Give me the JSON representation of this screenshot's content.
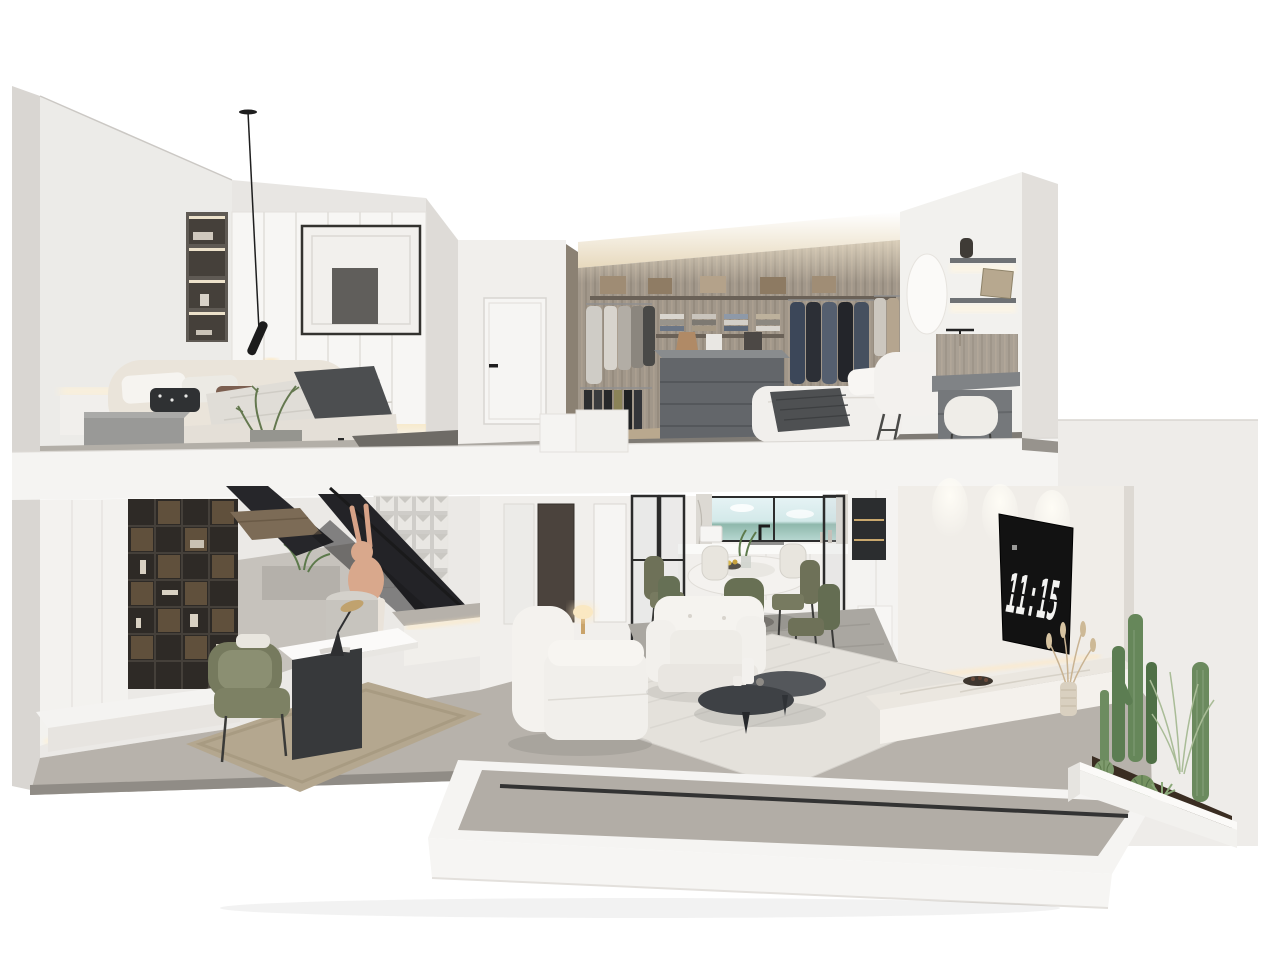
{
  "meta": {
    "description": "Photorealistic 3D dollhouse cutaway rendering of a two-storey duplex apartment, white/grey minimalist interior, viewed in section",
    "view": "isometric section cutaway",
    "floors": 2
  },
  "tv": {
    "clock_time": "11:15",
    "screen_color": "#121212",
    "digit_color": "#f3f3f1"
  },
  "palette": {
    "background": "#ffffff",
    "exterior_cut_wall": "#d9d6d2",
    "interior_wall": "#ecebe8",
    "wall_shadow_side": "#dedbd7",
    "slab_white": "#f5f4f2",
    "floor_gray": "#b7b2ab",
    "closet_carpet": "#7f7b75",
    "closet_wood": "#a1978a",
    "bookshelf_dark": "#2e2a26",
    "steel_black": "#232327",
    "olive_chair": "#6e7158",
    "bed_beige": "#eae4da",
    "duvet_gray": "#e0ddd7",
    "throw_dark": "#4c4e50",
    "rug_beige": "#b4a78f",
    "rug_cream": "#e4e1db",
    "marble": "#ebe7e0",
    "led_warm": "#ffe9c0",
    "rabbit_skin": "#d9a88c",
    "cactus_green": "#66875a",
    "soil_brown": "#3a2d22",
    "suit_navy": "#3c4759",
    "window_view_sky": "#e6f3f5",
    "window_view_hills": "#8fb8ac"
  },
  "scene": {
    "upper_floor": {
      "rooms": [
        {
          "name": "bedroom",
          "objects": [
            "pendant-lamp",
            "framed-artwork",
            "illuminated-niche-shelves",
            "white-wardrobe",
            "double-bed",
            "patterned-pillows",
            "gray-duvet",
            "dark-throw-blanket",
            "gray-nightstands",
            "plant",
            "led-wall-light"
          ]
        },
        {
          "name": "upper-hallway",
          "objects": [
            "white-door",
            "door-handle",
            "slab-steps"
          ]
        },
        {
          "name": "walk-in-closet",
          "objects": [
            "cove-lighting",
            "wood-panel-wall",
            "hanging-shirts",
            "hanging-pants",
            "hanging-suits",
            "folded-clothes-stacks",
            "storage-boxes",
            "island-dresser",
            "handbags",
            "amber-candle"
          ]
        },
        {
          "name": "master-bedroom-corner",
          "objects": [
            "bed-with-knit-throw",
            "white-headboard",
            "round-mirror",
            "floating-shelves",
            "vase",
            "leaning-frame",
            "wall-lamp",
            "vanity-desk",
            "boucle-stool",
            "step-ladder"
          ]
        }
      ]
    },
    "lower_floor": {
      "rooms": [
        {
          "name": "study",
          "objects": [
            "dark-grid-bookshelf",
            "lit-display-cells",
            "white-top-desk",
            "desk-lamp",
            "olive-armchair",
            "beige-rug",
            "white-plinth",
            "led-baseboard"
          ]
        },
        {
          "name": "stair-zone",
          "objects": [
            "black-steel-staircase",
            "handrail",
            "wood-treads",
            "glass-block-wall",
            "rabbit-sculpture",
            "cylinder-stool",
            "fern-plant",
            "platform-step-with-led"
          ]
        },
        {
          "name": "lower-hallway",
          "objects": [
            "dark-door",
            "white-door-frames"
          ]
        },
        {
          "name": "dining-kitchen",
          "objects": [
            "kitchen-window-with-view",
            "black-faucet",
            "kitchen-counter",
            "marble-columns",
            "glass-partitions",
            "round-marble-dining-table",
            "lazy-susan",
            "fruit-bowl",
            "table-plant",
            "olive-dining-chairs",
            "cream-dining-chairs",
            "gray-rug",
            "tall-cabinets",
            "dark-display-niche",
            "white-bench"
          ]
        },
        {
          "name": "living-room",
          "objects": [
            "white-armchair-back",
            "white-armchair-front",
            "two-tier-dark-coffee-table",
            "white-vases",
            "side-table",
            "small-table-lamp",
            "cream-striped-rug",
            "wall-tv-with-flip-clock",
            "spotlights",
            "marble-bench",
            "decorative-bowl",
            "dried-grass-vase"
          ]
        },
        {
          "name": "terrace",
          "objects": [
            "white-floor-slab",
            "recessed-gray-floor",
            "door-track-groove",
            "cactus-planter",
            "columnar-cacti",
            "ball-cacti",
            "grass-plumes",
            "soil-bed"
          ]
        }
      ]
    }
  }
}
